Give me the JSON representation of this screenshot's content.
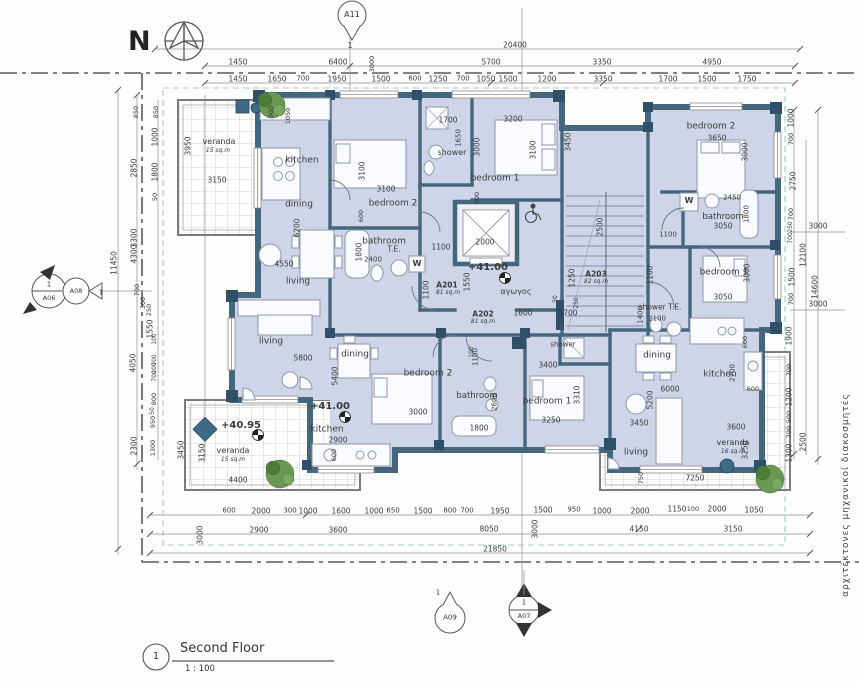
{
  "north": {
    "label": "N"
  },
  "title_block": {
    "number": "1",
    "title": "Second Floor",
    "scale": "1 : 100"
  },
  "side_text": "αρχιτέκτονες    μηχανικοί    διακοσμητές",
  "grid_markers": {
    "a11": {
      "id": "A11",
      "ref": "1"
    },
    "a06": {
      "id": "A06",
      "num": "1",
      "ref": "1"
    },
    "a08": {
      "id": "A08"
    },
    "a09": {
      "id": "A09",
      "ref": "1"
    },
    "a07": {
      "id": "A07",
      "num": "1"
    }
  },
  "colors": {
    "room_fill": "#cfd5e8",
    "wall": "#45677e",
    "wall_dark": "#2f5068",
    "setback_dash": "#a5cdc9",
    "tree": "#5d8a4a",
    "planter": "#3f6a86",
    "dim_text": "#3b3b3b"
  },
  "labels": {
    "dims_top": [
      {
        "t": "20400",
        "x": 515,
        "y": 45
      },
      {
        "t": "1450",
        "x": 238,
        "y": 62
      },
      {
        "t": "6400",
        "x": 338,
        "y": 62
      },
      {
        "t": "3000",
        "x": 372,
        "y": 64,
        "r": -90,
        "s": 6.5
      },
      {
        "t": "5700",
        "x": 491,
        "y": 62
      },
      {
        "t": "3350",
        "x": 602,
        "y": 62
      },
      {
        "t": "4950",
        "x": 712,
        "y": 62
      },
      {
        "t": "1450",
        "x": 238,
        "y": 79
      },
      {
        "t": "1650",
        "x": 277,
        "y": 79
      },
      {
        "t": "700",
        "x": 303,
        "y": 79,
        "s": 7
      },
      {
        "t": "1950",
        "x": 337,
        "y": 79
      },
      {
        "t": "1500",
        "x": 381,
        "y": 79
      },
      {
        "t": "600",
        "x": 415,
        "y": 79,
        "s": 7
      },
      {
        "t": "1250",
        "x": 438,
        "y": 79
      },
      {
        "t": "700",
        "x": 463,
        "y": 79,
        "s": 7
      },
      {
        "t": "1050",
        "x": 486,
        "y": 79
      },
      {
        "t": "1500",
        "x": 508,
        "y": 79
      },
      {
        "t": "1200",
        "x": 547,
        "y": 79
      },
      {
        "t": "3350",
        "x": 603,
        "y": 79
      },
      {
        "t": "1700",
        "x": 668,
        "y": 79
      },
      {
        "t": "1500",
        "x": 707,
        "y": 79
      },
      {
        "t": "1750",
        "x": 747,
        "y": 79
      }
    ],
    "dims_left": [
      {
        "t": "11450",
        "x": 114,
        "y": 263,
        "r": -90
      },
      {
        "t": "850",
        "x": 136,
        "y": 112,
        "r": -90,
        "s": 6.5
      },
      {
        "t": "850",
        "x": 156,
        "y": 112,
        "r": -90,
        "s": 6.5
      },
      {
        "t": "1000",
        "x": 155,
        "y": 137,
        "r": -90
      },
      {
        "t": "2850",
        "x": 134,
        "y": 168,
        "r": -90
      },
      {
        "t": "1800",
        "x": 155,
        "y": 172,
        "r": -90
      },
      {
        "t": "50",
        "x": 155,
        "y": 197,
        "r": -90,
        "s": 6.5
      },
      {
        "t": "3300",
        "x": 134,
        "y": 238,
        "r": -90
      },
      {
        "t": "4300",
        "x": 134,
        "y": 254,
        "r": -90
      },
      {
        "t": "700",
        "x": 137,
        "y": 290,
        "r": -90,
        "s": 6.5
      },
      {
        "t": "300",
        "x": 143,
        "y": 303,
        "r": -90,
        "s": 6.5
      },
      {
        "t": "250",
        "x": 149,
        "y": 310,
        "r": -90,
        "s": 6.5
      },
      {
        "t": "1550",
        "x": 150,
        "y": 329,
        "r": -90
      },
      {
        "t": "100",
        "x": 155,
        "y": 339,
        "r": -90,
        "s": 6
      },
      {
        "t": "4050",
        "x": 133,
        "y": 363,
        "r": -90
      },
      {
        "t": "700",
        "x": 155,
        "y": 360,
        "r": -90,
        "s": 6
      },
      {
        "t": "200",
        "x": 155,
        "y": 368,
        "r": -90,
        "s": 6
      },
      {
        "t": "700",
        "x": 155,
        "y": 376,
        "r": -90,
        "s": 6
      },
      {
        "t": "800",
        "x": 154,
        "y": 399,
        "r": -90,
        "s": 6.5
      },
      {
        "t": "50",
        "x": 153,
        "y": 411,
        "r": -90,
        "s": 6
      },
      {
        "t": "950",
        "x": 153,
        "y": 422,
        "r": -90,
        "s": 6.5
      },
      {
        "t": "2300",
        "x": 134,
        "y": 446,
        "r": -90
      },
      {
        "t": "1300",
        "x": 153,
        "y": 448,
        "r": -90,
        "s": 6.5
      },
      {
        "t": "3950",
        "x": 188,
        "y": 146,
        "r": -90
      },
      {
        "t": "3450",
        "x": 181,
        "y": 450,
        "r": -90
      },
      {
        "t": "3150",
        "x": 202,
        "y": 453,
        "r": -90
      },
      {
        "t": "3000",
        "x": 200,
        "y": 535,
        "r": -90
      },
      {
        "t": "900",
        "x": 271,
        "y": 112,
        "r": -90,
        "s": 6.5
      },
      {
        "t": "1050",
        "x": 288,
        "y": 116,
        "r": -90,
        "s": 6.5
      }
    ],
    "dims_right": [
      {
        "t": "1000",
        "x": 791,
        "y": 118,
        "r": -90
      },
      {
        "t": "700",
        "x": 791,
        "y": 139,
        "r": -90,
        "s": 6.5
      },
      {
        "t": "2750",
        "x": 793,
        "y": 181,
        "r": -90
      },
      {
        "t": "700",
        "x": 791,
        "y": 214,
        "r": -90,
        "s": 6.5
      },
      {
        "t": "250",
        "x": 791,
        "y": 227,
        "r": -90,
        "s": 6
      },
      {
        "t": "700",
        "x": 791,
        "y": 238,
        "r": -90,
        "s": 6
      },
      {
        "t": "12100",
        "x": 803,
        "y": 255,
        "r": -90
      },
      {
        "t": "1500",
        "x": 792,
        "y": 277,
        "r": -90
      },
      {
        "t": "700",
        "x": 791,
        "y": 299,
        "r": -90,
        "s": 6.5
      },
      {
        "t": "14600",
        "x": 815,
        "y": 287,
        "r": -90
      },
      {
        "t": "3000",
        "x": 818,
        "y": 226
      },
      {
        "t": "3000",
        "x": 818,
        "y": 304
      },
      {
        "t": "1900",
        "x": 789,
        "y": 336,
        "r": -90
      },
      {
        "t": "700",
        "x": 789,
        "y": 370,
        "r": -90,
        "s": 6.5
      },
      {
        "t": "1200",
        "x": 789,
        "y": 397,
        "r": -90
      },
      {
        "t": "500",
        "x": 789,
        "y": 417,
        "r": -90,
        "s": 6.5
      },
      {
        "t": "700",
        "x": 789,
        "y": 432,
        "r": -90,
        "s": 6.5
      },
      {
        "t": "1300",
        "x": 789,
        "y": 453,
        "r": -90
      },
      {
        "t": "2500",
        "x": 803,
        "y": 442,
        "r": -90
      }
    ],
    "dims_bottom": [
      {
        "t": "600",
        "x": 229,
        "y": 511,
        "s": 7
      },
      {
        "t": "2000",
        "x": 261,
        "y": 511
      },
      {
        "t": "300",
        "x": 290,
        "y": 511,
        "s": 7
      },
      {
        "t": "1000",
        "x": 308,
        "y": 511
      },
      {
        "t": "1600",
        "x": 341,
        "y": 511
      },
      {
        "t": "1000",
        "x": 374,
        "y": 511
      },
      {
        "t": "650",
        "x": 393,
        "y": 511,
        "s": 7
      },
      {
        "t": "1500",
        "x": 423,
        "y": 511
      },
      {
        "t": "800",
        "x": 450,
        "y": 511,
        "s": 7
      },
      {
        "t": "700",
        "x": 467,
        "y": 511,
        "s": 7
      },
      {
        "t": "1950",
        "x": 500,
        "y": 511
      },
      {
        "t": "1500",
        "x": 543,
        "y": 510
      },
      {
        "t": "950",
        "x": 574,
        "y": 510,
        "s": 7
      },
      {
        "t": "1000",
        "x": 602,
        "y": 511
      },
      {
        "t": "2000",
        "x": 640,
        "y": 511
      },
      {
        "t": "1150",
        "x": 677,
        "y": 509
      },
      {
        "t": "100",
        "x": 693,
        "y": 509,
        "s": 6.5
      },
      {
        "t": "2000",
        "x": 717,
        "y": 509
      },
      {
        "t": "1050",
        "x": 754,
        "y": 510
      },
      {
        "t": "2900",
        "x": 259,
        "y": 530
      },
      {
        "t": "3600",
        "x": 338,
        "y": 530
      },
      {
        "t": "8050",
        "x": 489,
        "y": 529
      },
      {
        "t": "4150",
        "x": 639,
        "y": 529
      },
      {
        "t": "3150",
        "x": 733,
        "y": 529
      },
      {
        "t": "21850",
        "x": 495,
        "y": 549
      },
      {
        "t": "3000",
        "x": 535,
        "y": 529,
        "r": -90
      }
    ],
    "dims_inner": [
      {
        "t": "3100",
        "x": 362,
        "y": 171,
        "r": -90
      },
      {
        "t": "3100",
        "x": 386,
        "y": 189
      },
      {
        "t": "600",
        "x": 361,
        "y": 216,
        "r": -90,
        "s": 6.5
      },
      {
        "t": "6200",
        "x": 297,
        "y": 228,
        "r": -90
      },
      {
        "t": "4550",
        "x": 284,
        "y": 264
      },
      {
        "t": "1800",
        "x": 359,
        "y": 252,
        "r": -90
      },
      {
        "t": "2400",
        "x": 373,
        "y": 260,
        "s": 7
      },
      {
        "t": "1100",
        "x": 441,
        "y": 247
      },
      {
        "t": "1100",
        "x": 426,
        "y": 290,
        "r": -90
      },
      {
        "t": "1550",
        "x": 467,
        "y": 282,
        "r": -90
      },
      {
        "t": "1700",
        "x": 448,
        "y": 120
      },
      {
        "t": "1650",
        "x": 459,
        "y": 138,
        "r": -90,
        "s": 7
      },
      {
        "t": "3000",
        "x": 477,
        "y": 147,
        "r": -90
      },
      {
        "t": "3200",
        "x": 513,
        "y": 119
      },
      {
        "t": "3100",
        "x": 533,
        "y": 150,
        "r": -90
      },
      {
        "t": "3450",
        "x": 568,
        "y": 142,
        "r": -90
      },
      {
        "t": "600",
        "x": 477,
        "y": 198,
        "r": -90,
        "s": 6.5
      },
      {
        "t": "2000",
        "x": 485,
        "y": 242
      },
      {
        "t": "2500",
        "x": 600,
        "y": 227,
        "r": -90
      },
      {
        "t": "1250",
        "x": 572,
        "y": 278,
        "r": -90
      },
      {
        "t": "50",
        "x": 556,
        "y": 299,
        "r": -90,
        "s": 6
      },
      {
        "t": "250",
        "x": 577,
        "y": 303,
        "r": -90,
        "s": 6
      },
      {
        "t": "1600",
        "x": 523,
        "y": 313
      },
      {
        "t": "1700",
        "x": 568,
        "y": 313
      },
      {
        "t": "100",
        "x": 472,
        "y": 352,
        "r": -90,
        "s": 6
      },
      {
        "t": "1400",
        "x": 641,
        "y": 315,
        "r": -90,
        "s": 7
      },
      {
        "t": "2100",
        "x": 657,
        "y": 319,
        "s": 7
      },
      {
        "t": "3650",
        "x": 717,
        "y": 138
      },
      {
        "t": "3000",
        "x": 745,
        "y": 152,
        "r": -90
      },
      {
        "t": "2450",
        "x": 732,
        "y": 198,
        "s": 7
      },
      {
        "t": "3050",
        "x": 723,
        "y": 226
      },
      {
        "t": "1800",
        "x": 747,
        "y": 214,
        "r": -90,
        "s": 7
      },
      {
        "t": "1100",
        "x": 668,
        "y": 235,
        "s": 7
      },
      {
        "t": "1100",
        "x": 650,
        "y": 275,
        "r": -90
      },
      {
        "t": "3000",
        "x": 747,
        "y": 273,
        "r": -90
      },
      {
        "t": "3050",
        "x": 723,
        "y": 297
      },
      {
        "t": "3400",
        "x": 548,
        "y": 365
      },
      {
        "t": "3310",
        "x": 577,
        "y": 395,
        "r": -90
      },
      {
        "t": "3250",
        "x": 551,
        "y": 420
      },
      {
        "t": "3000",
        "x": 418,
        "y": 412
      },
      {
        "t": "5400",
        "x": 335,
        "y": 376,
        "r": -90
      },
      {
        "t": "1100",
        "x": 476,
        "y": 357,
        "r": -90,
        "s": 7
      },
      {
        "t": "2600",
        "x": 495,
        "y": 402,
        "r": -90,
        "s": 7
      },
      {
        "t": "1800",
        "x": 479,
        "y": 428
      },
      {
        "t": "5800",
        "x": 303,
        "y": 358
      },
      {
        "t": "2900",
        "x": 338,
        "y": 440
      },
      {
        "t": "600",
        "x": 334,
        "y": 455,
        "r": -90,
        "s": 6.5
      },
      {
        "t": "4400",
        "x": 238,
        "y": 480
      },
      {
        "t": "2700",
        "x": 733,
        "y": 373,
        "r": -90,
        "s": 7
      },
      {
        "t": "600",
        "x": 745,
        "y": 342,
        "r": -90,
        "s": 6.5
      },
      {
        "t": "600",
        "x": 753,
        "y": 389,
        "s": 6.5
      },
      {
        "t": "6000",
        "x": 670,
        "y": 389
      },
      {
        "t": "5200",
        "x": 650,
        "y": 400,
        "r": -90
      },
      {
        "t": "3450",
        "x": 639,
        "y": 423
      },
      {
        "t": "3600",
        "x": 736,
        "y": 427
      },
      {
        "t": "3250",
        "x": 745,
        "y": 450,
        "r": -90
      },
      {
        "t": "7250",
        "x": 695,
        "y": 478
      },
      {
        "t": "750",
        "x": 641,
        "y": 478,
        "r": -90,
        "s": 6.5
      },
      {
        "t": "3150",
        "x": 217,
        "y": 180
      }
    ],
    "room_labels": [
      {
        "t": "kitchen",
        "x": 302,
        "y": 161,
        "s": 9
      },
      {
        "t": "dining",
        "x": 299,
        "y": 205,
        "s": 9
      },
      {
        "t": "living",
        "x": 298,
        "y": 282,
        "s": 9
      },
      {
        "t": "bedroom 2",
        "x": 393,
        "y": 204,
        "s": 9
      },
      {
        "t": "bathroom",
        "x": 384,
        "y": 242,
        "s": 9
      },
      {
        "t": "shower",
        "x": 452,
        "y": 153,
        "s": 8
      },
      {
        "t": "bedroom 1",
        "x": 495,
        "y": 179,
        "s": 9
      },
      {
        "t": "bedroom 2",
        "x": 711,
        "y": 127,
        "s": 9
      },
      {
        "t": "bathroom",
        "x": 723,
        "y": 217,
        "s": 8.5
      },
      {
        "t": "bedroom 1",
        "x": 724,
        "y": 273,
        "s": 9
      },
      {
        "t": "shower T.E.",
        "x": 660,
        "y": 307,
        "s": 7.5
      },
      {
        "t": "dining",
        "x": 657,
        "y": 356,
        "s": 9
      },
      {
        "t": "kitchen",
        "x": 720,
        "y": 375,
        "s": 9
      },
      {
        "t": "living",
        "x": 636,
        "y": 453,
        "s": 9
      },
      {
        "t": "bedroom 2",
        "x": 428,
        "y": 374,
        "s": 9
      },
      {
        "t": "bathroom",
        "x": 477,
        "y": 396,
        "s": 8.5
      },
      {
        "t": "bedroom 1",
        "x": 547,
        "y": 402,
        "s": 9
      },
      {
        "t": "shower",
        "x": 563,
        "y": 345,
        "s": 7
      },
      {
        "t": "dining",
        "x": 355,
        "y": 355,
        "s": 9
      },
      {
        "t": "kitchen",
        "x": 327,
        "y": 430,
        "s": 9
      },
      {
        "t": "living",
        "x": 271,
        "y": 342,
        "s": 9
      },
      {
        "t": "αγωγος",
        "x": 516,
        "y": 292,
        "s": 8
      }
    ],
    "veranda_labels": [
      {
        "t": "veranda",
        "x": 219,
        "y": 142,
        "s": 8
      },
      {
        "t": "15 sq.m",
        "x": 218,
        "y": 151,
        "s": 6,
        "i": 1
      },
      {
        "t": "veranda",
        "x": 233,
        "y": 451,
        "s": 8
      },
      {
        "t": "15 sq.m",
        "x": 233,
        "y": 460,
        "s": 6,
        "i": 1
      },
      {
        "t": "veranda",
        "x": 733,
        "y": 443,
        "s": 8
      },
      {
        "t": "16 sq.m",
        "x": 733,
        "y": 452,
        "s": 6,
        "i": 1
      }
    ],
    "apartment_tags": [
      {
        "t": "A201",
        "x": 447,
        "y": 285,
        "s": 7.5,
        "w": 1
      },
      {
        "t": "81 sq.m",
        "x": 448,
        "y": 293,
        "s": 6,
        "i": 1
      },
      {
        "t": "A202",
        "x": 483,
        "y": 314,
        "s": 7.5,
        "w": 1
      },
      {
        "t": "81 sq.m",
        "x": 483,
        "y": 322,
        "s": 6,
        "i": 1
      },
      {
        "t": "A203",
        "x": 596,
        "y": 274,
        "s": 7.5,
        "w": 1
      },
      {
        "t": "82 sq.m",
        "x": 596,
        "y": 282,
        "s": 6,
        "i": 1
      }
    ],
    "level_values": [
      {
        "t": "+41.00",
        "x": 488,
        "y": 268,
        "s": 10,
        "w": 1
      },
      {
        "t": "+41.00",
        "x": 330,
        "y": 407,
        "s": 10,
        "w": 1
      },
      {
        "t": "+40.95",
        "x": 241,
        "y": 426,
        "s": 10,
        "w": 1
      }
    ],
    "fixture_labels": [
      {
        "t": "T.E.",
        "x": 394,
        "y": 249,
        "s": 7.5
      },
      {
        "t": "W",
        "x": 417,
        "y": 264,
        "s": 8,
        "w": 1
      },
      {
        "t": "W",
        "x": 689,
        "y": 201,
        "s": 8,
        "w": 1
      }
    ]
  }
}
